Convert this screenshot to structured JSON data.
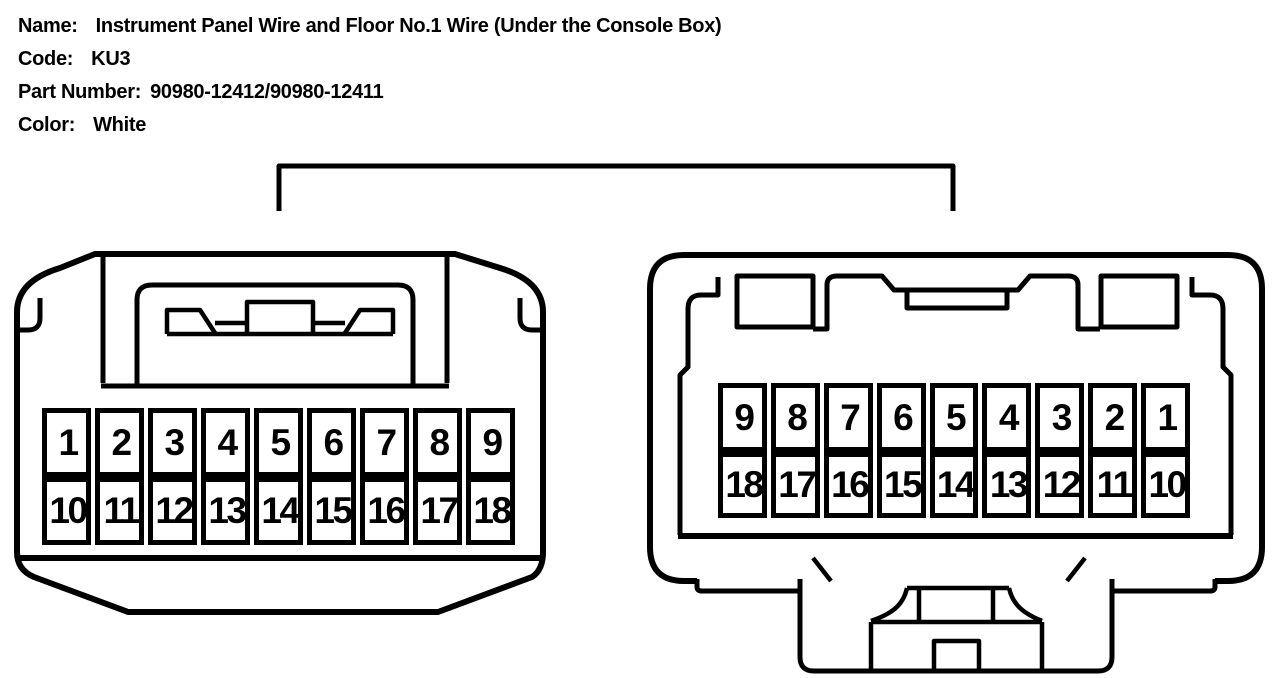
{
  "header": {
    "name_label": "Name:",
    "name_value": "Instrument Panel Wire and Floor No.1 Wire (Under the Console Box)",
    "code_label": "Code:",
    "code_value": "KU3",
    "part_number_label": "Part Number:",
    "part_number_value": "90980-12412/90980-12411",
    "color_label": "Color:",
    "color_value": "White"
  },
  "connectors": [
    {
      "id": "left",
      "pins_top": [
        "1",
        "2",
        "3",
        "4",
        "5",
        "6",
        "7",
        "8",
        "9"
      ],
      "pins_bottom": [
        "10",
        "11",
        "12",
        "13",
        "14",
        "15",
        "16",
        "17",
        "18"
      ]
    },
    {
      "id": "right",
      "pins_top": [
        "9",
        "8",
        "7",
        "6",
        "5",
        "4",
        "3",
        "2",
        "1"
      ],
      "pins_bottom": [
        "18",
        "17",
        "16",
        "15",
        "14",
        "13",
        "12",
        "11",
        "10"
      ]
    }
  ],
  "colors": {
    "line": "#000000",
    "background": "#ffffff"
  }
}
